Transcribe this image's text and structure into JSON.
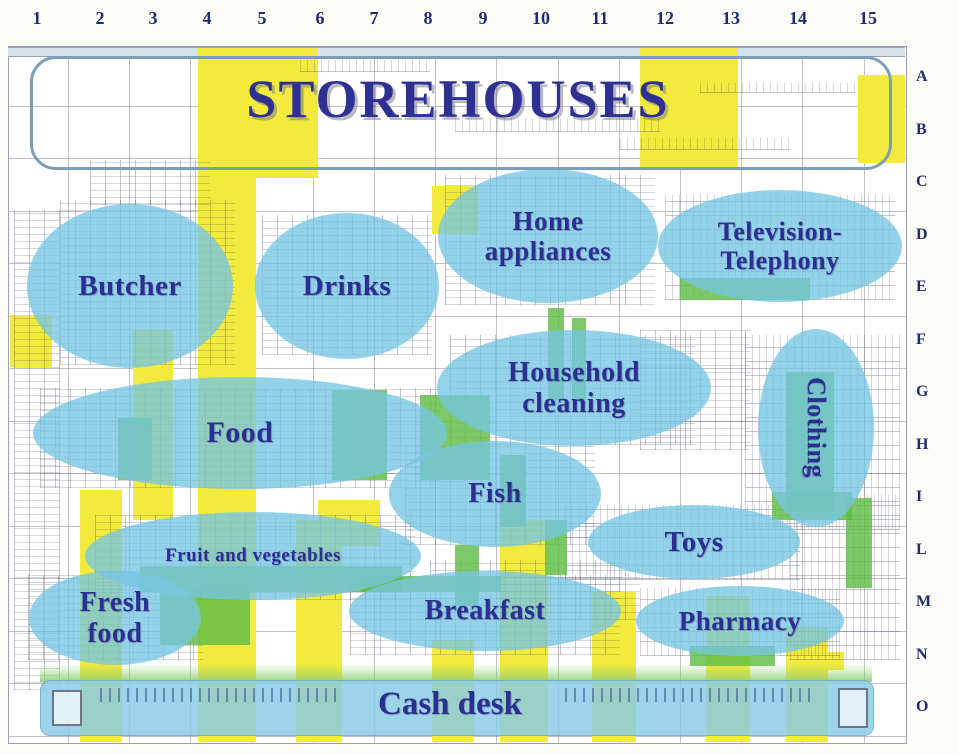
{
  "title": "STOREHOUSES",
  "grid": {
    "columns": [
      "1",
      "2",
      "3",
      "4",
      "5",
      "6",
      "7",
      "8",
      "9",
      "10",
      "11",
      "12",
      "13",
      "14",
      "15"
    ],
    "rows": [
      "A",
      "B",
      "C",
      "D",
      "E",
      "F",
      "G",
      "H",
      "I",
      "L",
      "M",
      "N",
      "O"
    ]
  },
  "departments": [
    {
      "id": "butcher",
      "lines": [
        "Butcher"
      ],
      "cx": 130,
      "cy": 286,
      "rx": 103,
      "ry": 82,
      "fs": 29
    },
    {
      "id": "drinks",
      "lines": [
        "Drinks"
      ],
      "cx": 347,
      "cy": 286,
      "rx": 92,
      "ry": 73,
      "fs": 29
    },
    {
      "id": "home-appliances",
      "lines": [
        "Home",
        "appliances"
      ],
      "cx": 548,
      "cy": 236,
      "rx": 110,
      "ry": 67,
      "fs": 27
    },
    {
      "id": "television-telephony",
      "lines": [
        "Television-",
        "Telephony"
      ],
      "cx": 780,
      "cy": 246,
      "rx": 122,
      "ry": 56,
      "fs": 26
    },
    {
      "id": "household-cleaning",
      "lines": [
        "Household",
        "cleaning"
      ],
      "cx": 574,
      "cy": 388,
      "rx": 137,
      "ry": 58,
      "fs": 28
    },
    {
      "id": "clothing",
      "lines": [
        "Clothing"
      ],
      "cx": 816,
      "cy": 428,
      "rx": 58,
      "ry": 99,
      "fs": 26,
      "rotate": 90
    },
    {
      "id": "food",
      "lines": [
        "Food"
      ],
      "cx": 240,
      "cy": 433,
      "rx": 207,
      "ry": 56,
      "fs": 30
    },
    {
      "id": "fish",
      "lines": [
        "Fish"
      ],
      "cx": 495,
      "cy": 494,
      "rx": 106,
      "ry": 53,
      "fs": 28
    },
    {
      "id": "fruit-and-vegetables",
      "lines": [
        "Fruit and vegetables"
      ],
      "cx": 253,
      "cy": 556,
      "rx": 168,
      "ry": 44,
      "fs": 19
    },
    {
      "id": "toys",
      "lines": [
        "Toys"
      ],
      "cx": 694,
      "cy": 542,
      "rx": 106,
      "ry": 37,
      "fs": 29
    },
    {
      "id": "fresh-food",
      "lines": [
        "Fresh",
        "food"
      ],
      "cx": 115,
      "cy": 618,
      "rx": 86,
      "ry": 47,
      "fs": 28
    },
    {
      "id": "breakfast",
      "lines": [
        "Breakfast"
      ],
      "cx": 485,
      "cy": 611,
      "rx": 136,
      "ry": 40,
      "fs": 28
    },
    {
      "id": "pharmacy",
      "lines": [
        "Pharmacy"
      ],
      "cx": 740,
      "cy": 621,
      "rx": 104,
      "ry": 35,
      "fs": 27
    }
  ],
  "cash_desk": {
    "label": "Cash desk"
  },
  "colors": {
    "label_text": "#2b2f92",
    "department_fill": "#76c5e3",
    "aisle_yellow": "#f3ea3e",
    "overlap_green": "#60bd46",
    "cash_band_blue": "#87cbe6",
    "grid_number_text": "#232a6e"
  }
}
